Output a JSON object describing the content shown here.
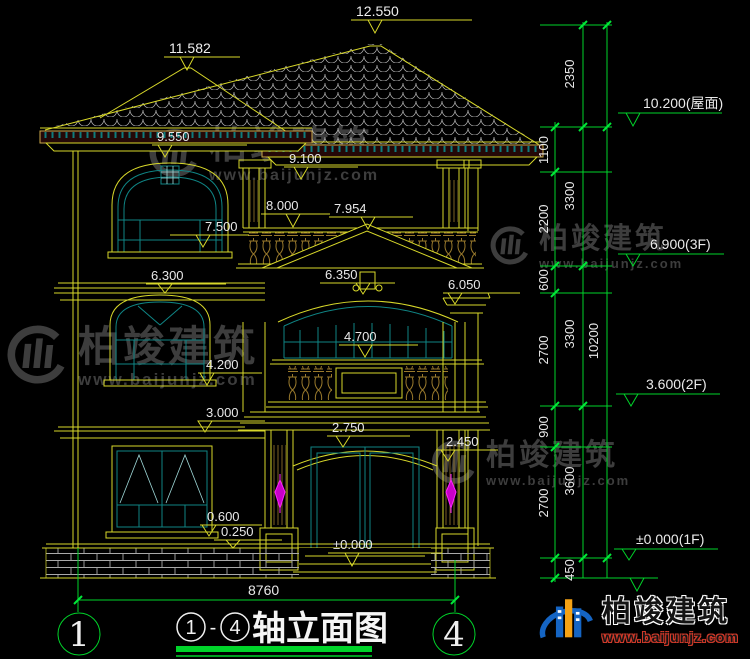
{
  "watermark": {
    "name": "柏竣建筑",
    "url": "www.baijunjz.com"
  },
  "logo": {
    "name": "柏竣建筑",
    "url": "www.baijunjz.com"
  },
  "title_block": {
    "axis_start": "1",
    "axis_end": "4",
    "separator": "-",
    "title_text": "轴立面图",
    "width_dim": "8760"
  },
  "elevations": {
    "ridge_main": "12.550",
    "ridge_left": "11.582",
    "eave_left": "9.550",
    "eave_right": "9.100",
    "balustrade_top": "8.000",
    "pediment_apex": "7.954",
    "window_sill_3f": "7.500",
    "band_3f_left": "6.300",
    "bay_arch_top": "6.350",
    "cornice_right": "6.050",
    "bay_sill_2f": "4.700",
    "window_sill_2f": "4.200",
    "band_2f_left": "3.000",
    "entry_arch_top": "2.750",
    "entry_arch_spring": "2.450",
    "window_sill_1f": "0.600",
    "plinth_top": "0.250",
    "ground_entry": "±0.000"
  },
  "levels": {
    "roof": "10.200(屋面)",
    "f3": "6.900(3F)",
    "f2": "3.600(2F)",
    "f1": "±0.000(1F)"
  },
  "dim_chain": {
    "inner": [
      "1100",
      "2200",
      "600",
      "2700",
      "900",
      "2700",
      "450"
    ],
    "middle": [
      "2350",
      "3300",
      "3300",
      "3600"
    ],
    "outer": [
      "10200"
    ]
  }
}
